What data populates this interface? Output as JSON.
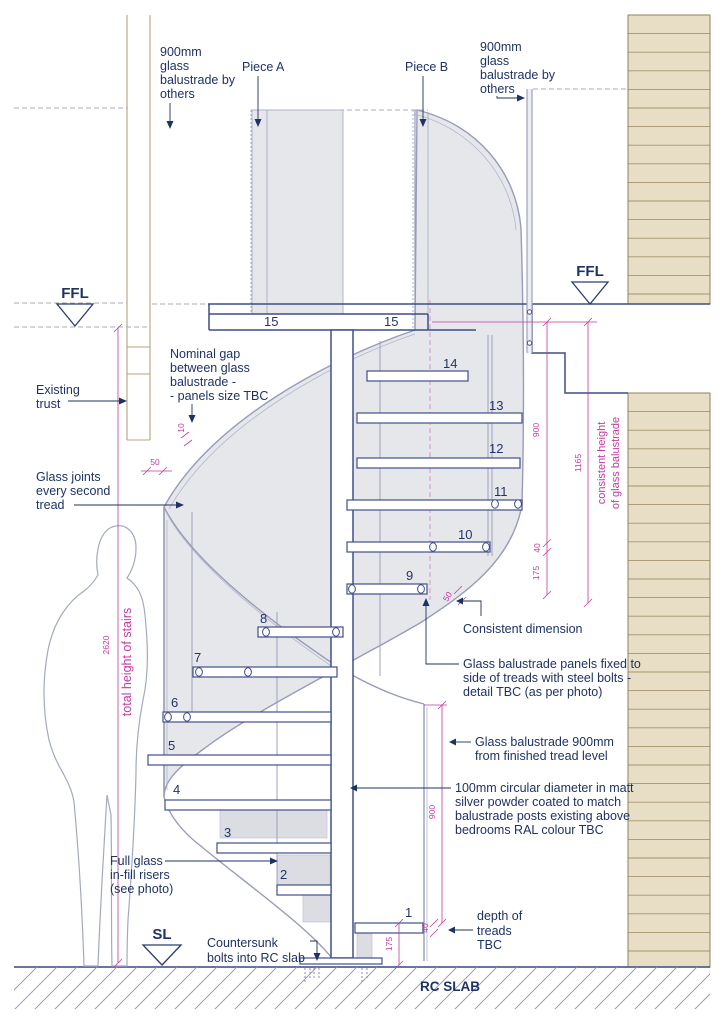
{
  "labels": {
    "piece_a": "Piece A",
    "piece_b": "Piece B",
    "ffl": "FFL",
    "sl": "SL",
    "rc_slab": "RC SLAB"
  },
  "annotations": {
    "balustrade_top_left": [
      "900mm",
      "glass",
      "balustrade by",
      "others"
    ],
    "balustrade_top_right": [
      "900mm",
      "glass",
      "balustrade by",
      "others"
    ],
    "existing_trust": [
      "Existing",
      "trust"
    ],
    "nominal_gap": [
      "Nominal gap",
      "between glass",
      "balustrade -",
      "- panels size TBC"
    ],
    "glass_joints": [
      "Glass joints",
      "every second",
      "tread"
    ],
    "consistent_dimension": "Consistent dimension",
    "panels_fixed": [
      "Glass balustrade panels fixed to",
      "side of treads with steel bolts -",
      "detail TBC (as per photo)"
    ],
    "balustrade_900": [
      "Glass balustrade 900mm",
      "from finished tread level"
    ],
    "post_100mm": [
      "100mm circular diameter in matt",
      "silver powder coated to match",
      "balustrade posts existing above",
      "bedrooms RAL colour TBC"
    ],
    "full_glass": [
      "Full glass",
      "in-fill risers",
      "(see photo)"
    ],
    "depth_of_treads": [
      "depth of",
      "treads",
      "TBC"
    ],
    "countersunk": [
      "Countersunk",
      "bolts into RC slab"
    ]
  },
  "dimensions": {
    "total_height_value": "2620",
    "total_height_label": "total height of stairs",
    "nominal_gap_value": "10",
    "joint_gap_value": "50",
    "upper_900": "900",
    "upper_1165": "1165",
    "consistent_height": [
      "consistent height",
      "of glass balustrade"
    ],
    "upper_40": "40",
    "upper_175": "175",
    "consistent_50": "50",
    "lower_900": "900",
    "lower_40": "40",
    "lower_175": "175"
  },
  "treads": [
    "1",
    "2",
    "3",
    "4",
    "5",
    "6",
    "7",
    "8",
    "9",
    "10",
    "11",
    "12",
    "13",
    "14",
    "15",
    "15"
  ],
  "colors": {
    "annotation_navy": "#1e3263",
    "dimension_magenta": "#c23a9e",
    "wall_tan": "#e8dec6",
    "wall_line": "#a5946e",
    "drawing_gray_blue": "#979cba",
    "glass_fill": "#e6e7ea"
  }
}
